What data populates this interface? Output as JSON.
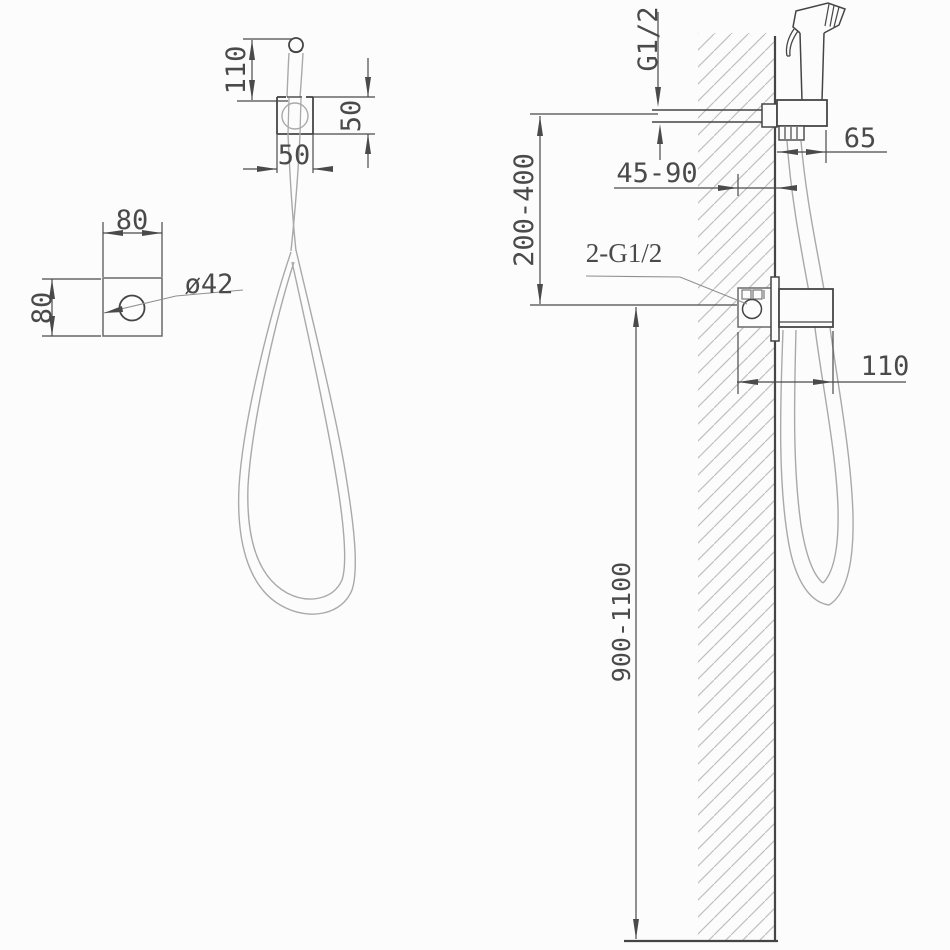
{
  "drawing": {
    "front_view": {
      "dims": {
        "tip_height": "110",
        "holder_height": "50",
        "holder_width": "50",
        "base_width": "80",
        "base_height": "80",
        "hole_diameter": "ø42"
      }
    },
    "side_view": {
      "dims": {
        "inlet_thread": "G1/2",
        "holder_depth": "65",
        "rough_in_depth": "45-90",
        "vertical_spacing": "200-400",
        "connections_label": "2-G1/2",
        "valve_depth": "110",
        "mounting_height": "900-1100"
      }
    },
    "colors": {
      "background": "#fcfcfc",
      "line_dark": "#454545",
      "line_medium": "#6a6a6a",
      "line_light": "#a9a9a9",
      "line_dim": "#4a4a4a",
      "hatch": "#bcc0c0",
      "text": "#4a4a4a"
    }
  }
}
